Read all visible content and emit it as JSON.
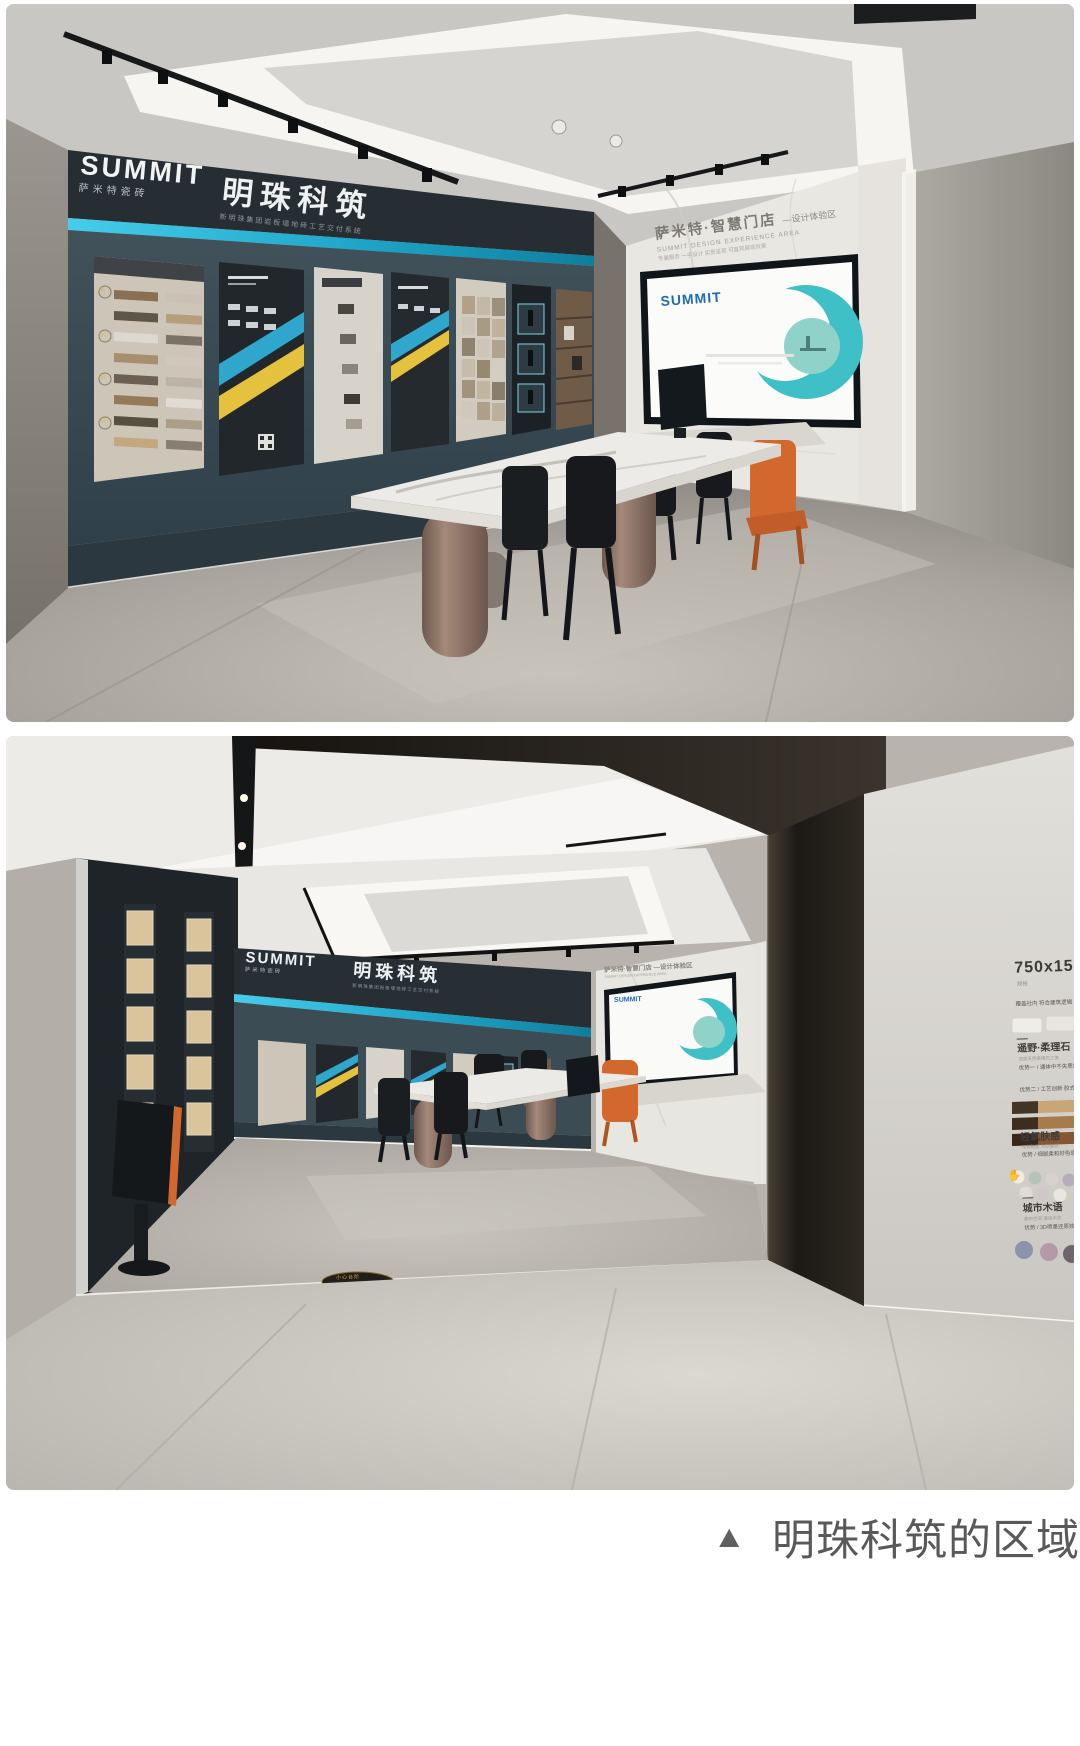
{
  "caption": {
    "marker": "▲",
    "text": "明珠科筑的区域"
  },
  "brand": {
    "logo": "SUMMIT",
    "logo_sub": "萨米特瓷砖",
    "studio": "明珠科筑",
    "studio_sub": "新明珠集团岩板墙地砖工艺交付系统"
  },
  "experience_wall": {
    "title": "萨米特·智慧门店",
    "title_suffix": "—设计体验区",
    "subtitle_en": "SUMMIT DESIGN EXPERIENCE AREA",
    "tagline": "专属服务 一手设计 实景呈现 可直观展现效果"
  },
  "tv": {
    "logo": "SUMMIT"
  },
  "sample_board": {
    "numbers": [
      "01",
      "02",
      "03",
      "04"
    ]
  },
  "product_wall": {
    "size": "750x1500",
    "size_sub": "规格",
    "intro": "覆盖社内 符合建筑逻辑",
    "sections": [
      {
        "title": "遥野·柔理石",
        "sub": "还原天然柔理石之美",
        "line1": "优势一 / 通体中不失质感",
        "line2": "优势二 / 工艺创新 胶式美学"
      },
      {
        "title": "轻氧肤感",
        "sub": "轻氧釉面 亲肤触感",
        "line1": "优势 / 细腻柔和好色感"
      },
      {
        "title": "城市木语",
        "sub": "都市空间 温润木纹",
        "line1": "优势 / 3D喷墨还原技术木纹"
      }
    ]
  },
  "floor_sign": "小心台阶",
  "icons": {
    "hand": "✋"
  },
  "colors": {
    "accent_cyan": "#2ab5d8",
    "brand_blue": "#1f6bb5",
    "accent_orange": "#d2682e",
    "wall_teal": "#3b4b54",
    "caption_gray": "#595959"
  }
}
